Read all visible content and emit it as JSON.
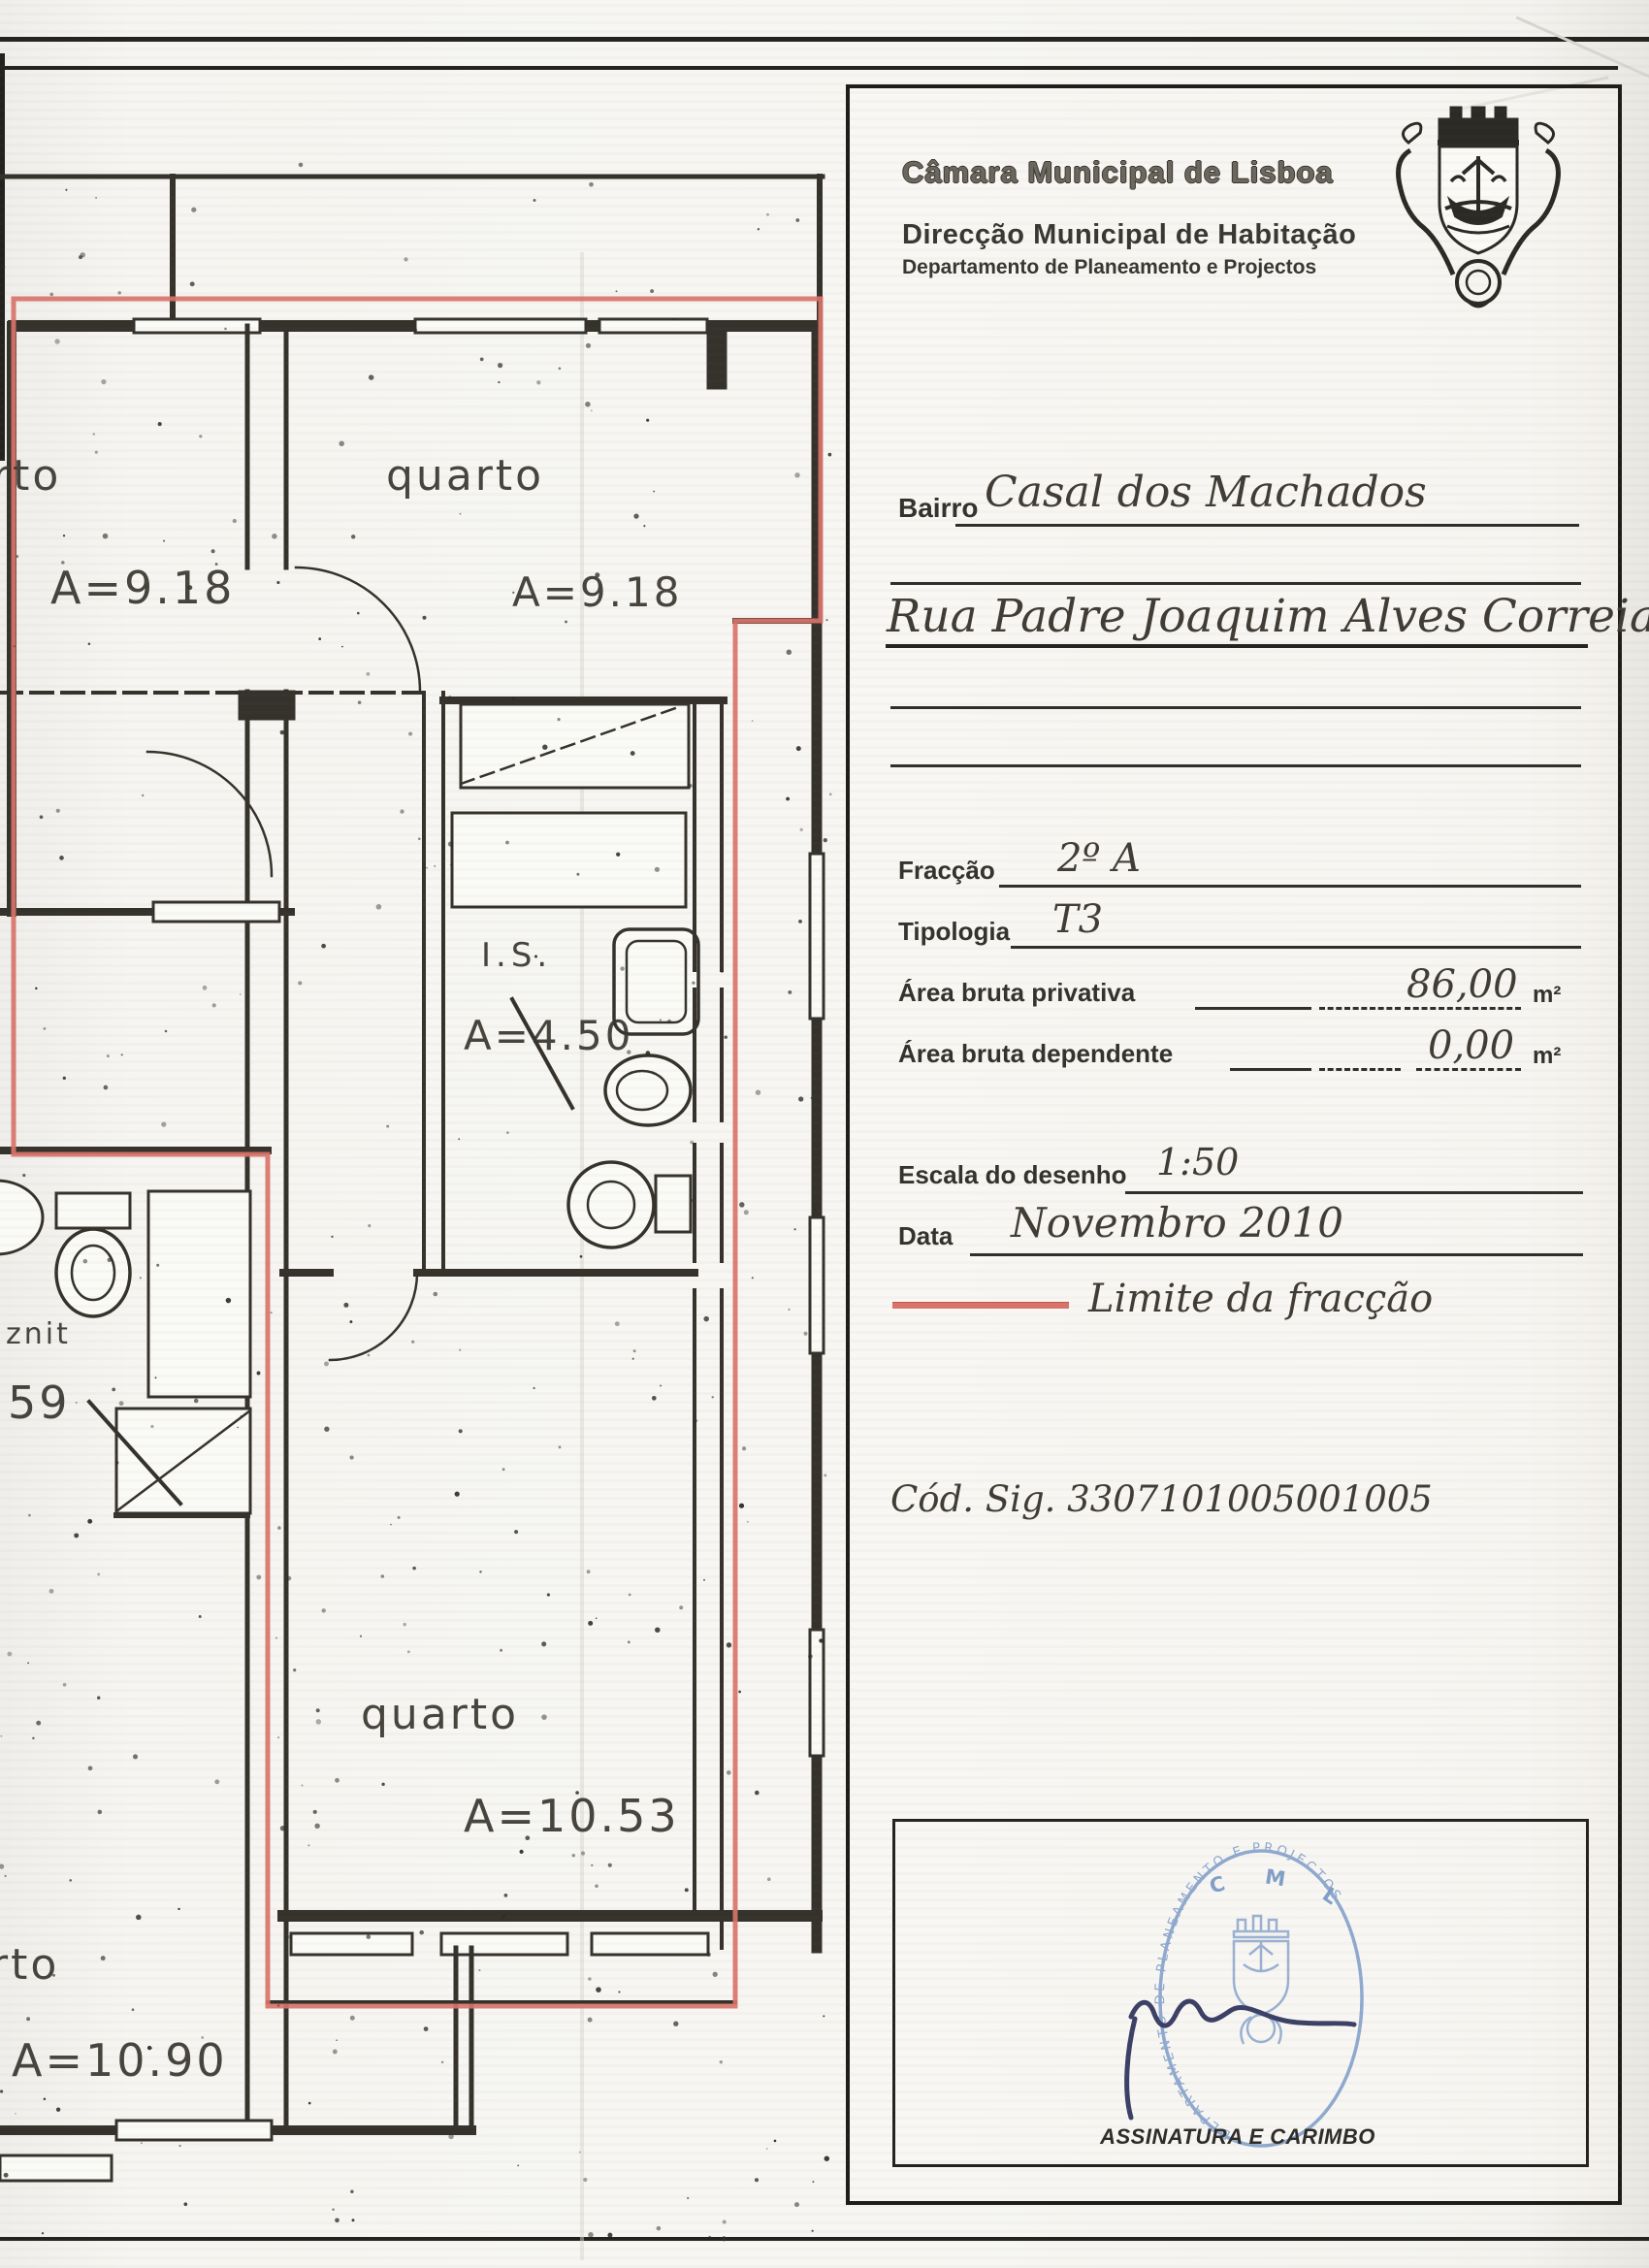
{
  "page": {
    "accent_red": "#d9736a",
    "stamp_blue": "#7d9cc9"
  },
  "header": {
    "org": "Câmara Municipal de Lisboa",
    "direction": "Direcção Municipal de Habitação",
    "department": "Departamento de Planeamento e Projectos",
    "arms_icon": "lisbon-coat-of-arms"
  },
  "form": {
    "bairro_label": "Bairro",
    "bairro_value": "Casal dos Machados",
    "address_value": "Rua Padre Joaquim Alves Correia, nº 6",
    "fraccao_label": "Fracção",
    "fraccao_value": "2º A",
    "tipologia_label": "Tipologia",
    "tipologia_value": "T3",
    "area_privativa_label": "Área bruta privativa",
    "area_privativa_value": "86,00",
    "area_privativa_unit": "m²",
    "area_dependente_label": "Área bruta dependente",
    "area_dependente_value": "0,00",
    "area_dependente_unit": "m²",
    "escala_label": "Escala do desenho",
    "escala_value": "1:50",
    "data_label": "Data",
    "data_value": "Novembro 2010",
    "legend_label": "Limite da fracção",
    "cod_sig": "Cód. Sig. 3307101005001005"
  },
  "signature": {
    "caption": "ASSINATURA E CARIMBO",
    "stamp_top": "C M L",
    "stamp_arc": "DEPARTAMENTO DE PLANEAMENTO E PROJECTOS"
  },
  "plan": {
    "rooms": [
      {
        "name": "rto",
        "area": "A=9.18"
      },
      {
        "name": "quarto",
        "area": "A=9.18"
      },
      {
        "name": "I.S.",
        "area": "A=4.50"
      },
      {
        "name": "znit",
        "area": "59"
      },
      {
        "name": "quarto",
        "area": "A=10.53"
      },
      {
        "name": "rto",
        "area": "A=10.90"
      }
    ]
  }
}
